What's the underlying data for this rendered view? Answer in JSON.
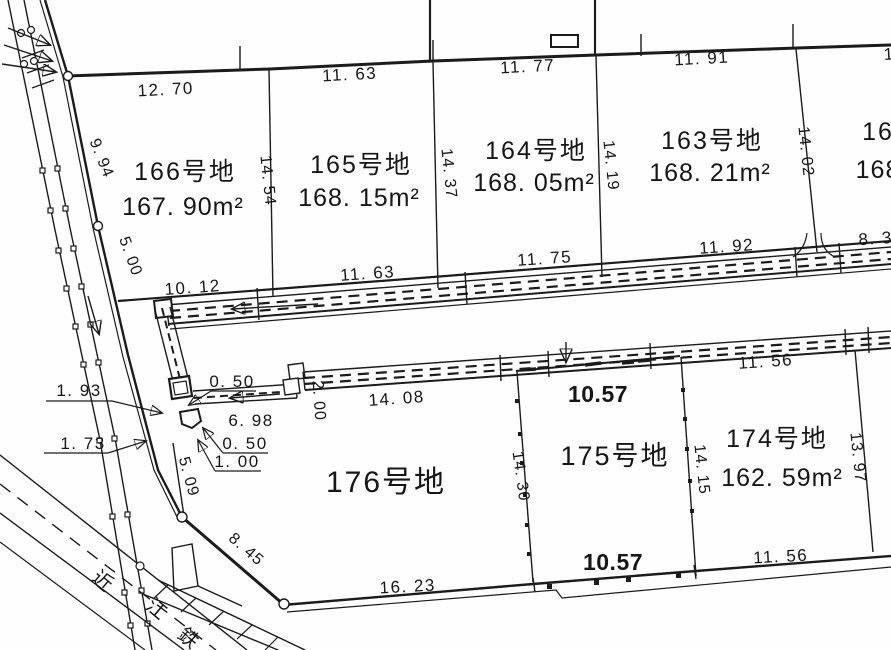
{
  "map": {
    "colors": {
      "ink": "#1b1b1b",
      "paper": "#fefefe"
    },
    "parcels": [
      {
        "name": "166号地",
        "area": "167. 90m²"
      },
      {
        "name": "165号地",
        "area": "168. 15m²"
      },
      {
        "name": "164号地",
        "area": "168. 05m²"
      },
      {
        "name": "163号地",
        "area": "168. 21m²"
      },
      {
        "name": "16",
        "area": "168"
      },
      {
        "name": "176号地"
      },
      {
        "name": "175号地"
      },
      {
        "name": "174号地",
        "area": "162. 59m²"
      }
    ],
    "dims": [
      "12. 70",
      "11. 63",
      "11. 77",
      "11. 91",
      "13",
      "14. 54",
      "14. 37",
      "14. 19",
      "14. 02",
      "9. 94",
      "5. 00",
      "5. 09",
      "8. 45",
      "10. 12",
      "11. 63",
      "11. 75",
      "11. 92",
      "8. 3",
      "1. 93",
      "0. 50",
      "6. 98",
      "0. 50",
      "1. 00",
      "1. 73",
      "2. 00",
      "14. 08",
      "11. 56",
      "14. 30",
      "14. 15",
      "13. 97",
      "16. 23",
      "11. 56"
    ],
    "width_annotations": [
      "10.57",
      "10.57"
    ],
    "railway_name_chars": [
      "近",
      "江",
      "鉄",
      "道"
    ]
  }
}
